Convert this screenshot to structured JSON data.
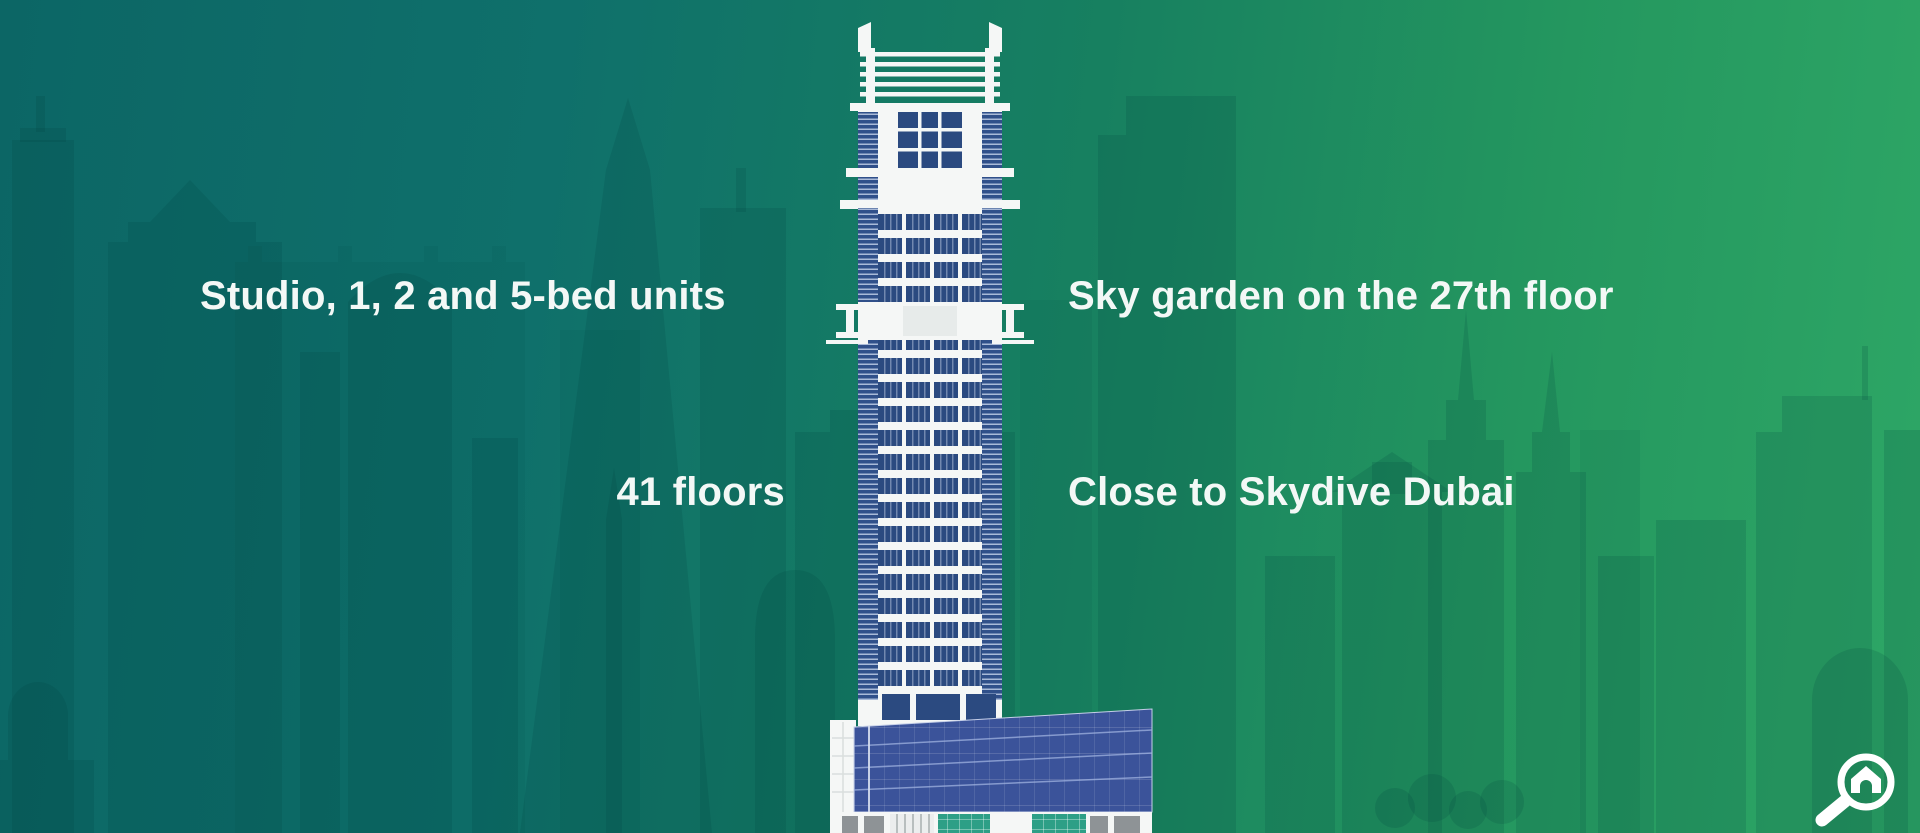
{
  "infographic": {
    "features": [
      {
        "id": "units",
        "label": "Studio, 1, 2 and 5-bed units"
      },
      {
        "id": "sky_garden",
        "label": "Sky garden on the 27th floor"
      },
      {
        "id": "floors",
        "label": "41 floors"
      },
      {
        "id": "skydive",
        "label": "Close to Skydive Dubai"
      }
    ],
    "illustration": "high-rise tower with podium",
    "brand_icon": "home-magnifier-icon",
    "colors": {
      "bg_gradient_start": "#0c6665",
      "bg_gradient_end": "#2ea766",
      "skyline_silhouette": "#003d3d",
      "building_frame": "#f5f7f6",
      "window_navy": "#2b4a80",
      "podium_glass": "#3b539a",
      "ground_glass_teal": "#2d9f86",
      "text": "#f3f8f6"
    }
  }
}
